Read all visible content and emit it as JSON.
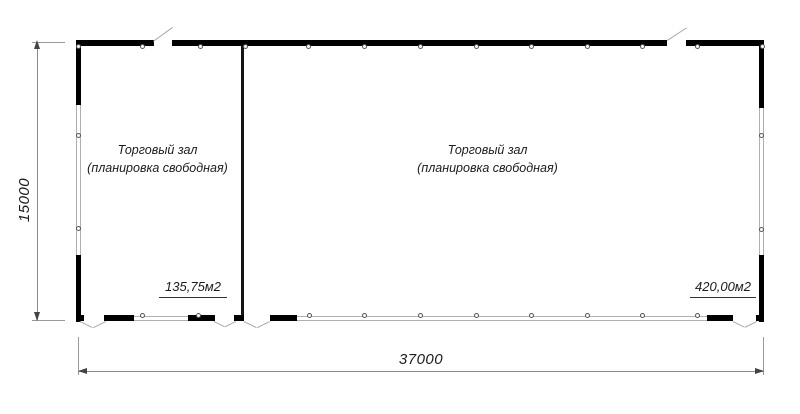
{
  "rooms": [
    {
      "label_line1": "Торговый зал",
      "label_line2": "(планировка свободная)",
      "area_label": "135,75м2"
    },
    {
      "label_line1": "Торговый зал",
      "label_line2": "(планировка свободная)",
      "area_label": "420,00м2"
    }
  ],
  "dimensions": {
    "vertical": "15000",
    "horizontal": "37000"
  },
  "colors": {
    "wall": "#000000",
    "glazing": "#b0b0b0",
    "dim": "#8a8a8a",
    "ink": "#1c1c1c"
  }
}
